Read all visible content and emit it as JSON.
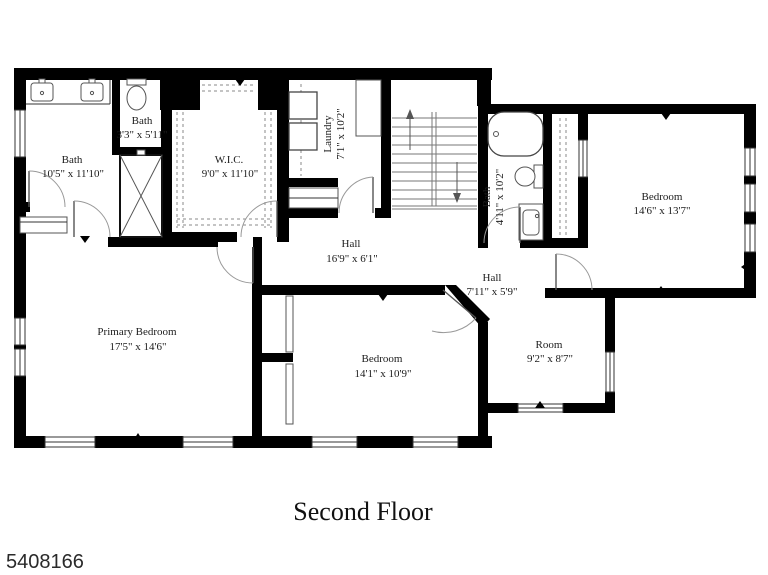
{
  "title": "Second Floor",
  "listing_id": "5408166",
  "colors": {
    "wall": "#000000",
    "background": "#ffffff",
    "text": "#1c1c1c"
  },
  "rooms": [
    {
      "id": "bath-main",
      "name": "Bath",
      "dims": "10'5\" x 11'10\""
    },
    {
      "id": "bath-small",
      "name": "Bath",
      "dims": "3'3\" x 5'11\""
    },
    {
      "id": "wic",
      "name": "W.I.C.",
      "dims": "9'0\" x 11'10\""
    },
    {
      "id": "laundry",
      "name": "Laundry",
      "dims": "7'1\" x 10'2\"",
      "rotated": true
    },
    {
      "id": "bath-hall",
      "name": "Bath",
      "dims": "4'11\" x 10'2\"",
      "rotated": true
    },
    {
      "id": "bedroom-right",
      "name": "Bedroom",
      "dims": "14'6\" x 13'7\""
    },
    {
      "id": "hall-main",
      "name": "Hall",
      "dims": "16'9\" x 6'1\""
    },
    {
      "id": "hall-small",
      "name": "Hall",
      "dims": "7'11\" x 5'9\""
    },
    {
      "id": "primary-bedroom",
      "name": "Primary Bedroom",
      "dims": "17'5\" x 14'6\""
    },
    {
      "id": "bedroom-middle",
      "name": "Bedroom",
      "dims": "14'1\" x 10'9\""
    },
    {
      "id": "room",
      "name": "Room",
      "dims": "9'2\" x 8'7\""
    }
  ],
  "fixtures": [
    "double-sink-vanity",
    "toilet",
    "shower",
    "bathtub",
    "washer-dryer",
    "stairs-up",
    "stairs-down",
    "linen-closet",
    "closet-rods"
  ]
}
